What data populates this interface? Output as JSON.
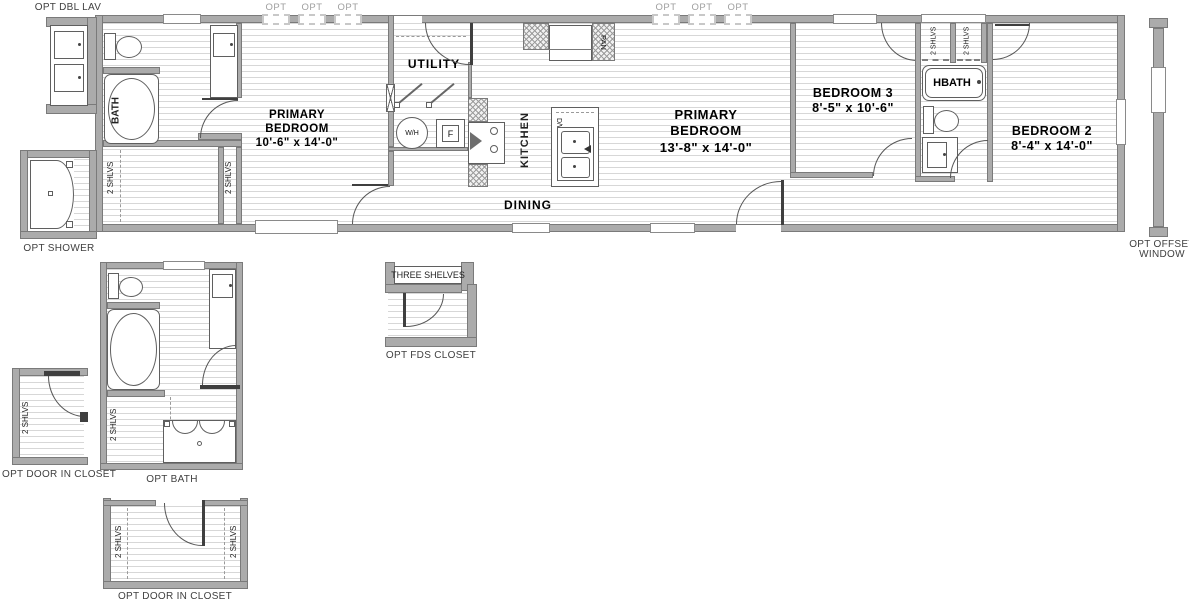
{
  "colors": {
    "wall": "#ababab",
    "wall_edge": "#7a7a7a",
    "floor_line": "#d7d7d7",
    "fixture_stroke": "#5f5f5f",
    "opt_tag_gray": "#9e9e9e",
    "label_text": "#000000",
    "caption_text": "#3f3f3f"
  },
  "rooms": {
    "bath": {
      "label": "BATH"
    },
    "primary_bedroom_left": {
      "line1": "PRIMARY",
      "line2": "BEDROOM",
      "dims": "10'-6\" x 14'-0\""
    },
    "utility": {
      "label": "UTILITY"
    },
    "kitchen": {
      "label": "KITCHEN"
    },
    "dining": {
      "label": "DINING"
    },
    "primary_bedroom_right": {
      "line1": "PRIMARY",
      "line2": "BEDROOM",
      "dims": "13'-8\" x 14'-0\""
    },
    "bedroom_3": {
      "name": "BEDROOM 3",
      "dims": "8'-5\" x 10'-6\""
    },
    "hbath": {
      "label": "HBATH"
    },
    "bedroom_2": {
      "name": "BEDROOM 2",
      "dims": "8'-4\" x 14'-0\""
    }
  },
  "fixtures": {
    "water_heater": "W/H",
    "furnace": "F",
    "dishwasher": "D/W",
    "pantry": "PAN",
    "two_shelves": "2 SHLVS",
    "three_shelves": "THREE SHELVES"
  },
  "options": {
    "window_tag": "OPT",
    "dbl_lav": "OPT DBL LAV",
    "shower": "OPT SHOWER",
    "door_in_closet": "OPT DOOR IN CLOSET",
    "bath": "OPT BATH",
    "fds_closet": "OPT FDS CLOSET",
    "offset_window_line1": "OPT OFFSET",
    "offset_window_line2": "WINDOW"
  }
}
